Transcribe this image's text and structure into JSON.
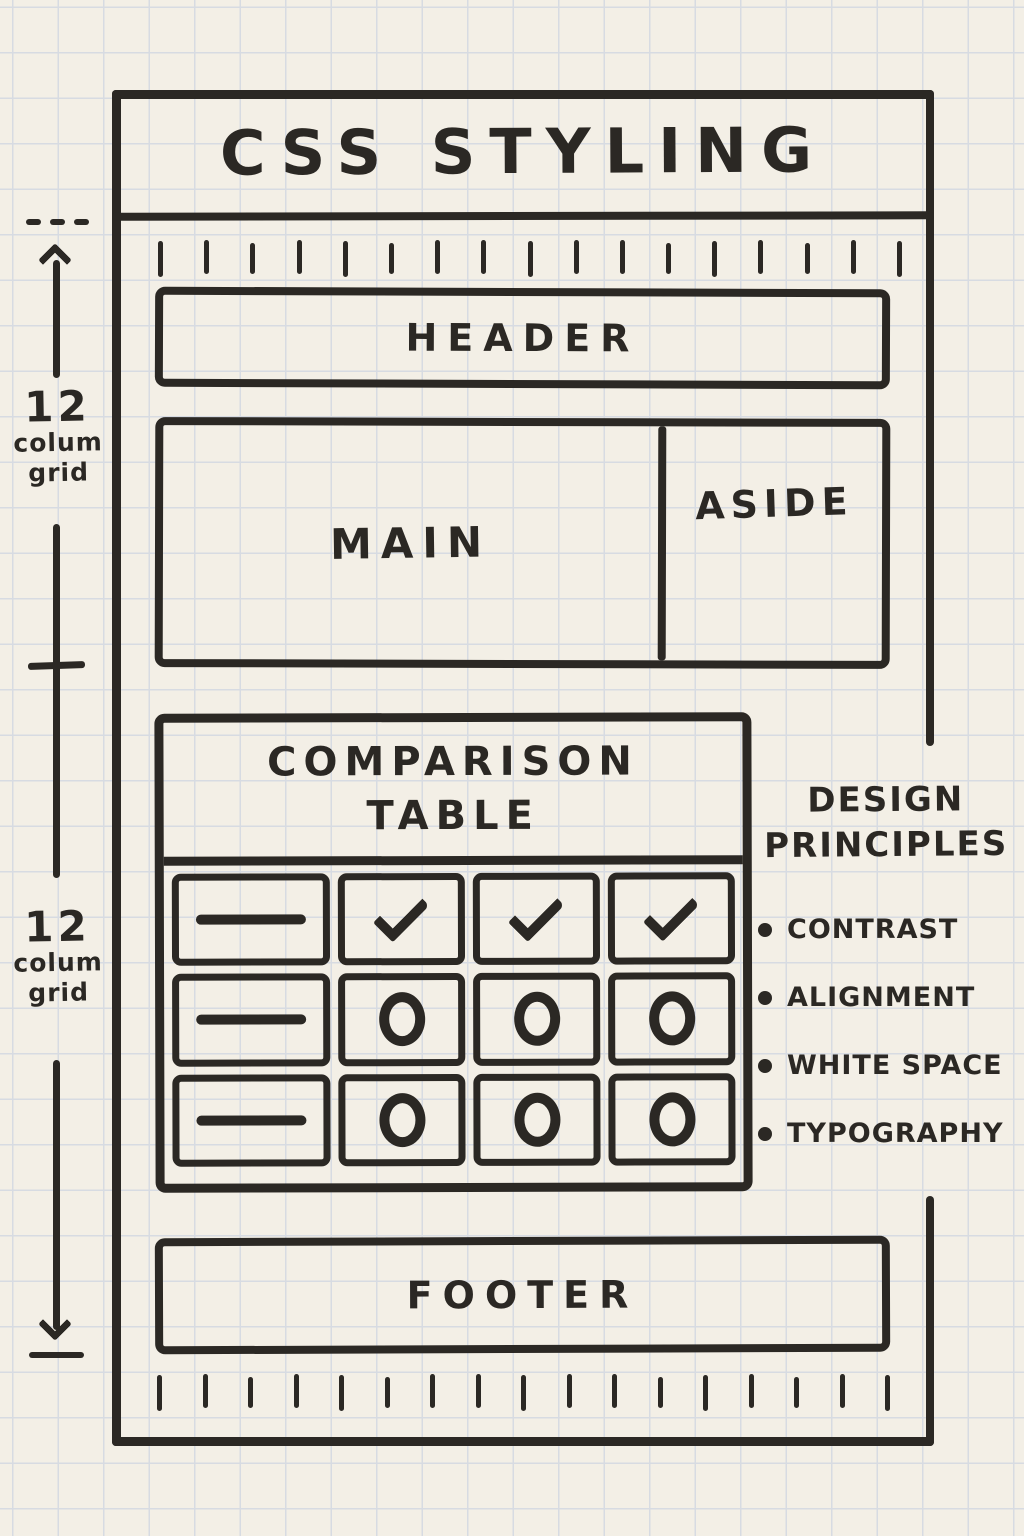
{
  "title": "CSS STYLING",
  "wireframe": {
    "header_label": "HEADER",
    "main_label": "MAIN",
    "aside_label": "ASIDE",
    "footer_label": "FOOTER"
  },
  "comparison_table": {
    "title_line1": "COMPARISON",
    "title_line2": "TABLE",
    "rows": [
      [
        "dash",
        "check",
        "check",
        "check"
      ],
      [
        "dash",
        "circle",
        "circle",
        "circle"
      ],
      [
        "dash",
        "circle",
        "circle",
        "circle"
      ]
    ]
  },
  "design_principles": {
    "title_line1": "DESIGN",
    "title_line2": "PRINCIPLES",
    "items": [
      "CONTRAST",
      "ALIGNMENT",
      "WHITE SPACE",
      "TYPOGRAPHY"
    ]
  },
  "measure_left": {
    "upper": {
      "value": "12",
      "word1": "colum",
      "word2": "grid"
    },
    "lower": {
      "value": "12",
      "word1": "colum",
      "word2": "grid"
    }
  },
  "colors": {
    "paper": "#f3efe6",
    "grid_line": "#d7dbe2",
    "ink": "#2b2824"
  }
}
